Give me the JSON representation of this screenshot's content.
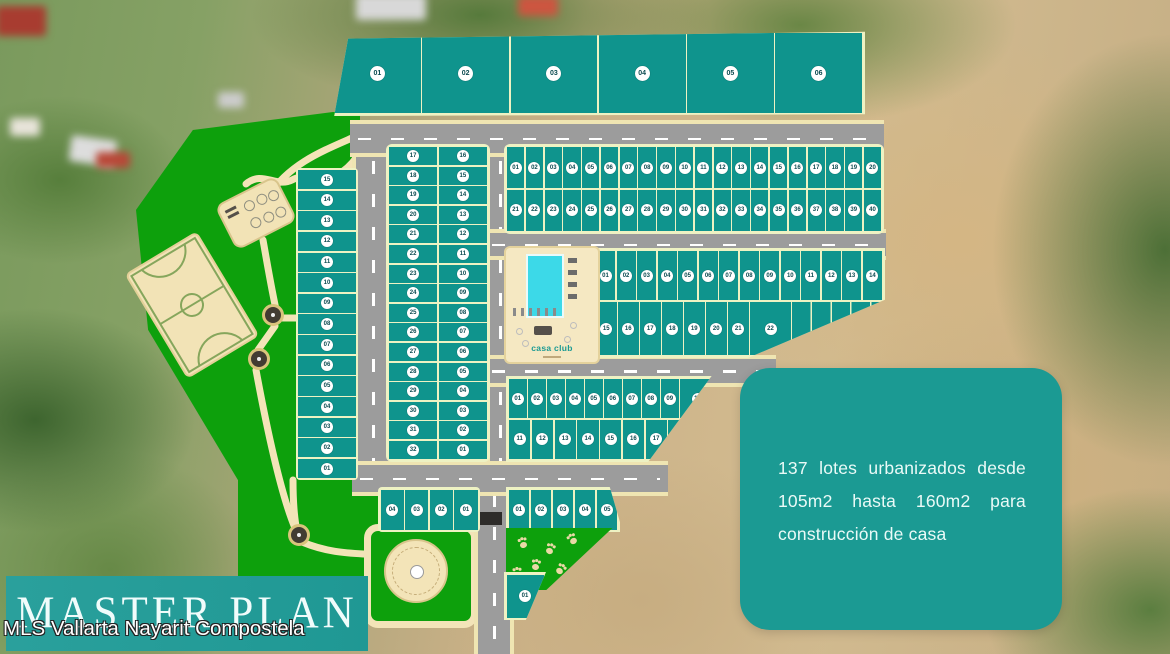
{
  "page": {
    "title": "MASTER PLAN",
    "watermark": "MLS Vallarta Nayarit Compostela"
  },
  "info_box": {
    "text": "137 lotes urbanizados desde 105m2 hasta 160m2 para construcción de casa"
  },
  "casa_club": {
    "label": "casa club"
  },
  "colors": {
    "lot_teal": "#0f948d",
    "park_green": "#0da00c",
    "road_gray": "#9c9c9c",
    "path_beige": "#f3e4b8",
    "panel_teal": "#1b9a93",
    "pool_cyan": "#3cd9e8"
  },
  "lots": {
    "groups": {
      "big": [
        "01",
        "02",
        "03",
        "04",
        "05",
        "06"
      ],
      "left_column": [
        "15",
        "14",
        "13",
        "12",
        "11",
        "10",
        "09",
        "08",
        "07",
        "06",
        "05",
        "04",
        "03",
        "02",
        "01"
      ],
      "center_left": [
        "17",
        "18",
        "19",
        "20",
        "21",
        "22",
        "23",
        "24",
        "25",
        "26",
        "27",
        "28",
        "29",
        "30",
        "31",
        "32"
      ],
      "center_right": [
        "16",
        "15",
        "14",
        "13",
        "12",
        "11",
        "10",
        "09",
        "08",
        "07",
        "06",
        "05",
        "04",
        "03",
        "02",
        "01"
      ],
      "rowA_top": [
        "01",
        "02",
        "03",
        "04",
        "05",
        "06",
        "07",
        "08",
        "09",
        "10",
        "11",
        "12",
        "13",
        "14",
        "15",
        "16",
        "17",
        "18",
        "19",
        "20"
      ],
      "rowA_bottom": [
        "21",
        "22",
        "23",
        "24",
        "25",
        "26",
        "27",
        "28",
        "29",
        "30",
        "31",
        "32",
        "33",
        "34",
        "35",
        "36",
        "37",
        "38",
        "39",
        "40"
      ],
      "club_top": [
        "01",
        "02",
        "03",
        "04",
        "05",
        "06",
        "07",
        "08",
        "09",
        "10",
        "11",
        "12",
        "13",
        "14"
      ],
      "club_bottom": [
        "15",
        "16",
        "17",
        "18",
        "19",
        "20",
        "21",
        "22"
      ],
      "blockC_top": [
        "01",
        "02",
        "03",
        "04",
        "05",
        "06",
        "07",
        "08",
        "09",
        "10"
      ],
      "blockC_bottom": [
        "11",
        "12",
        "13",
        "14",
        "15",
        "16",
        "17",
        "18"
      ],
      "bottom_left": [
        "04",
        "03",
        "02",
        "01"
      ],
      "bottom_right": [
        "01",
        "02",
        "03",
        "04",
        "05"
      ],
      "single": [
        "01"
      ]
    }
  }
}
